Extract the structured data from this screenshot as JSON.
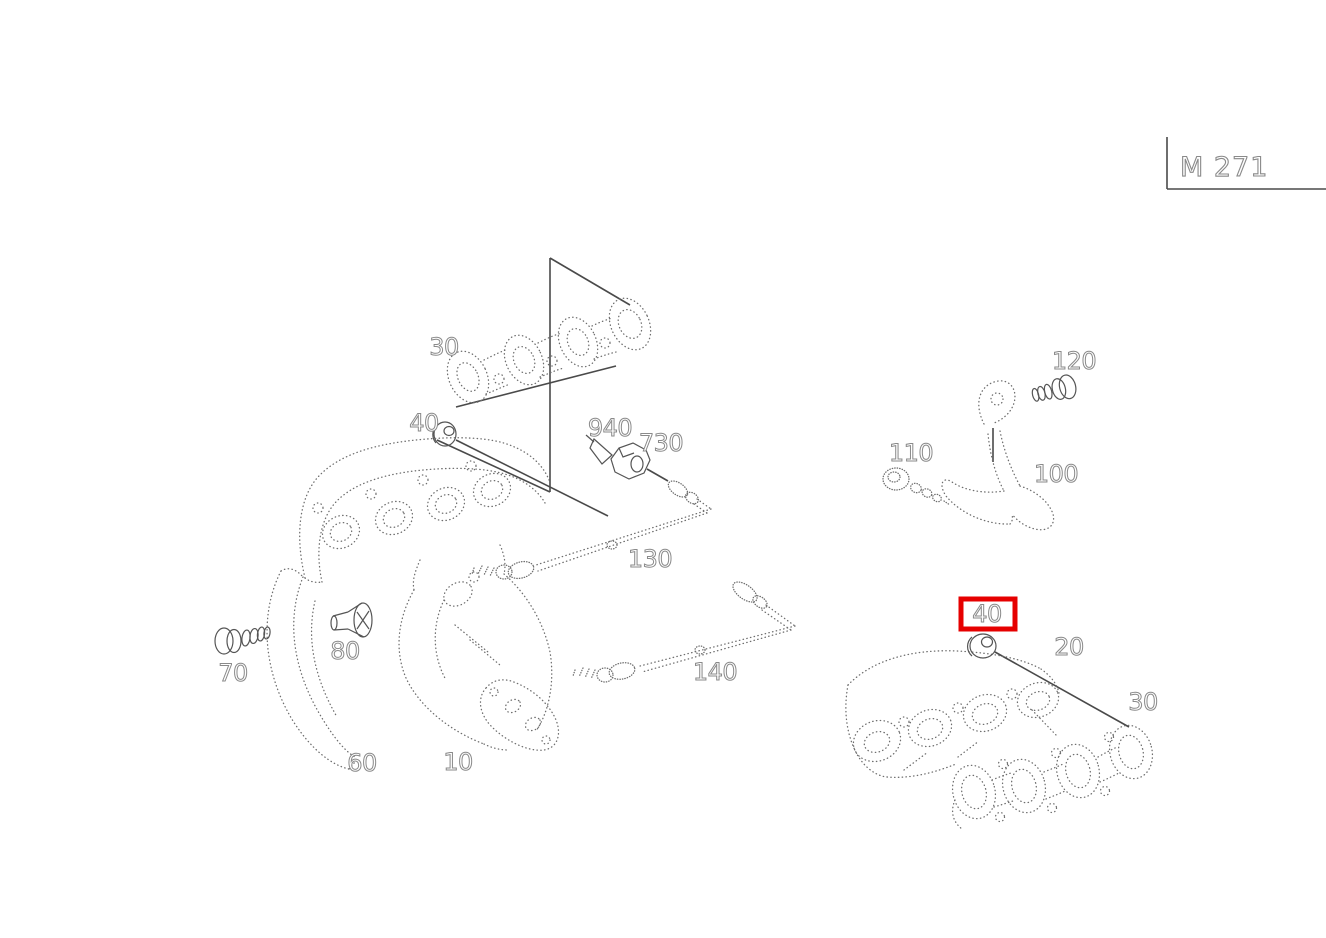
{
  "title_block": {
    "code": "M 271"
  },
  "colors": {
    "background": "#ffffff",
    "solid_line": "#4a4a4a",
    "stipple_line": "#6e6e6e",
    "label_outline": "#8a8a8a",
    "highlight": "#e60000"
  },
  "highlight_box": {
    "x": 961,
    "y": 599,
    "width": 54,
    "height": 30
  },
  "part_labels": [
    {
      "id": "30-top",
      "text": "30",
      "x": 444,
      "y": 355
    },
    {
      "id": "40-left",
      "text": "40",
      "x": 424,
      "y": 431
    },
    {
      "id": "940",
      "text": "940",
      "x": 610,
      "y": 436
    },
    {
      "id": "730",
      "text": "730",
      "x": 661,
      "y": 451
    },
    {
      "id": "130",
      "text": "130",
      "x": 650,
      "y": 567
    },
    {
      "id": "140",
      "text": "140",
      "x": 715,
      "y": 680
    },
    {
      "id": "70",
      "text": "70",
      "x": 233,
      "y": 681
    },
    {
      "id": "80",
      "text": "80",
      "x": 345,
      "y": 659
    },
    {
      "id": "60",
      "text": "60",
      "x": 362,
      "y": 771
    },
    {
      "id": "10",
      "text": "10",
      "x": 458,
      "y": 770
    },
    {
      "id": "120",
      "text": "120",
      "x": 1074,
      "y": 369
    },
    {
      "id": "110",
      "text": "110",
      "x": 911,
      "y": 461
    },
    {
      "id": "100",
      "text": "100",
      "x": 1056,
      "y": 482
    },
    {
      "id": "40-highlighted",
      "text": "40",
      "x": 987,
      "y": 622,
      "highlighted": true
    },
    {
      "id": "20",
      "text": "20",
      "x": 1069,
      "y": 655
    },
    {
      "id": "30-bottom",
      "text": "30",
      "x": 1143,
      "y": 710
    }
  ]
}
